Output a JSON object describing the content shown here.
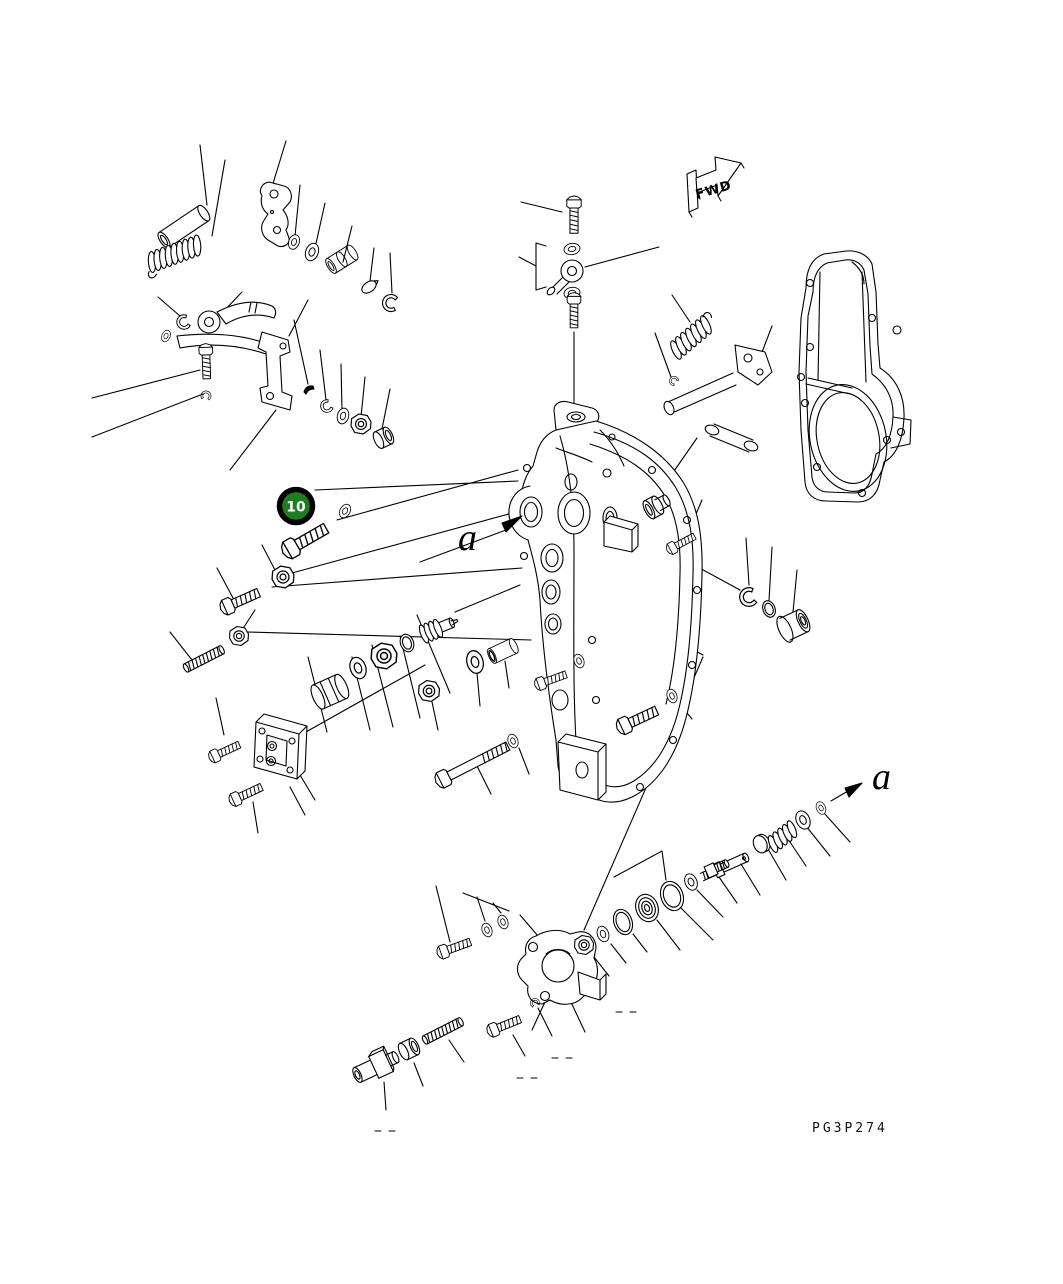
{
  "page": {
    "width": 1063,
    "height": 1284,
    "background": "#ffffff",
    "ink": "#000000"
  },
  "diagram": {
    "type": "exploded-parts-diagram",
    "drawing_code": "PG3P274",
    "direction_arrow": {
      "label": "FWD"
    },
    "callouts": [
      {
        "number": "10",
        "shape": "circle",
        "fill": "#1e7e1e",
        "ring_color": "#000000",
        "text_color": "#ffffff"
      }
    ],
    "view_labels": [
      {
        "text": "a",
        "position": "center-left"
      },
      {
        "text": "a",
        "position": "lower-right"
      }
    ],
    "parts": [
      {
        "id": "pin",
        "label": "pin"
      },
      {
        "id": "tension-spring",
        "label": "tension spring"
      },
      {
        "id": "cam-lever",
        "label": "cam lever"
      },
      {
        "id": "washer-set",
        "label": "washer set"
      },
      {
        "id": "bushing",
        "label": "bushing"
      },
      {
        "id": "taper-pin",
        "label": "taper pin"
      },
      {
        "id": "snap-ring",
        "label": "snap ring"
      },
      {
        "id": "control-lever",
        "label": "control lever"
      },
      {
        "id": "pivot-bracket",
        "label": "pivot bracket"
      },
      {
        "id": "hex-bolt",
        "label": "hex bolt"
      },
      {
        "id": "woodruff-key",
        "label": "woodruff key"
      },
      {
        "id": "lock-nut",
        "label": "lock nut"
      },
      {
        "id": "banjo-fitting",
        "label": "eye joint fitting"
      },
      {
        "id": "joint-bolt",
        "label": "joint bolt"
      },
      {
        "id": "governor-cover",
        "label": "governor cover housing"
      },
      {
        "id": "rear-cover-plate",
        "label": "cover plate"
      },
      {
        "id": "governor-spring",
        "label": "governor spring"
      },
      {
        "id": "shaft-lever",
        "label": "shaft lever assembly"
      },
      {
        "id": "screw-plug",
        "label": "screw plug"
      },
      {
        "id": "sleeve",
        "label": "sleeve"
      },
      {
        "id": "valve-piston",
        "label": "valve piston"
      },
      {
        "id": "adjusting-screw",
        "label": "adjusting screw"
      },
      {
        "id": "stud",
        "label": "stud"
      },
      {
        "id": "inspection-cover",
        "label": "inspection cover"
      },
      {
        "id": "valve-body",
        "label": "valve body"
      },
      {
        "id": "o-ring",
        "label": "o-ring"
      },
      {
        "id": "spring-seat",
        "label": "spring seat"
      },
      {
        "id": "valve-stem",
        "label": "valve stem"
      },
      {
        "id": "union",
        "label": "union fitting"
      }
    ]
  }
}
